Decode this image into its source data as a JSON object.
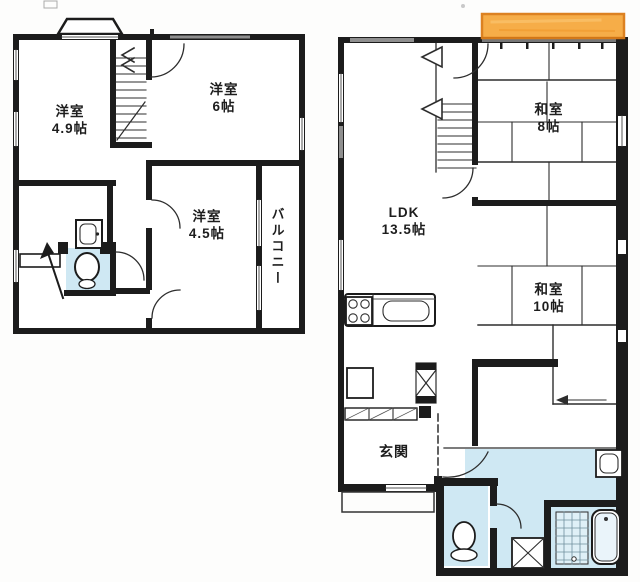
{
  "colors": {
    "wall": "#1c1c1c",
    "thin_line": "#2d2d2d",
    "water_blue": "#cfe8f3",
    "tile_blue": "#dff0f7",
    "highlight_orange": "#f6a93f",
    "highlight_border": "#db7b16",
    "window_gray": "#8f8f8f"
  },
  "floor2": {
    "rooms": {
      "y49": {
        "name": "洋室",
        "size": "4.9帖"
      },
      "y6": {
        "name": "洋室",
        "size": "6帖"
      },
      "y45": {
        "name": "洋室",
        "size": "4.5帖"
      },
      "balcony": {
        "name": "バルコニー"
      }
    }
  },
  "floor1": {
    "rooms": {
      "ldk": {
        "name": "LDK",
        "size": "13.5帖"
      },
      "w8": {
        "name": "和室",
        "size": "8帖"
      },
      "w10": {
        "name": "和室",
        "size": "10帖"
      },
      "genkan": {
        "name": "玄関"
      }
    }
  }
}
